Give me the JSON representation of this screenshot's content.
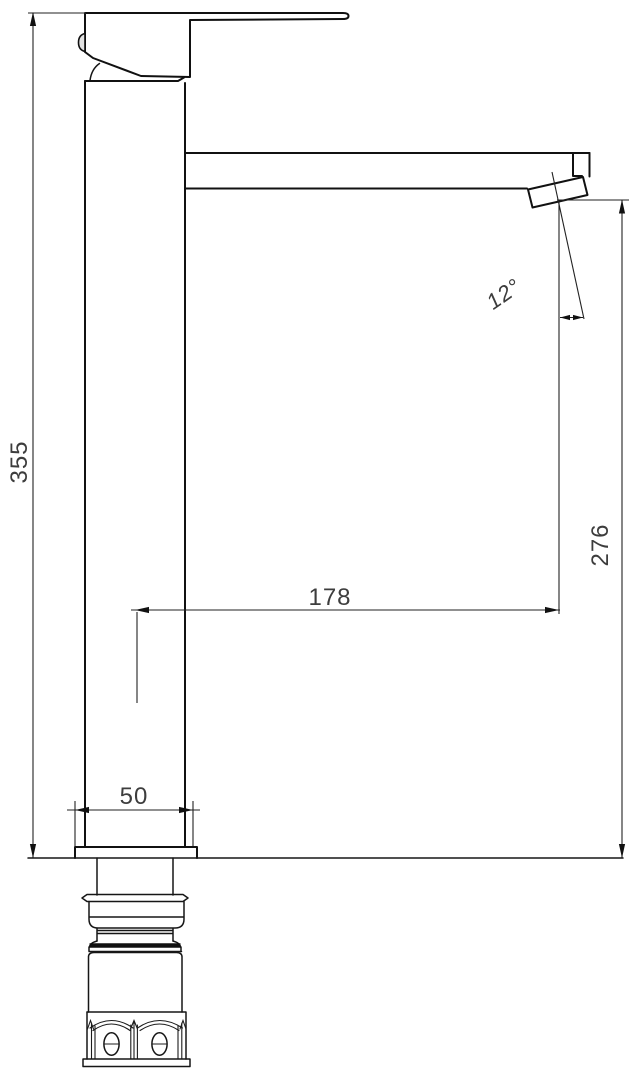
{
  "drawing": {
    "kind": "technical-dimension-drawing",
    "subject": "tall single-lever basin mixer tap, side elevation",
    "dimension_labels": {
      "overall_height": "355",
      "spout_projection": "178",
      "outlet_height": "276",
      "base_width": "50",
      "outlet_angle": "12°"
    },
    "colors": {
      "line": "#111111",
      "dimension_text": "#3d3d3d",
      "background": "#ffffff"
    }
  }
}
